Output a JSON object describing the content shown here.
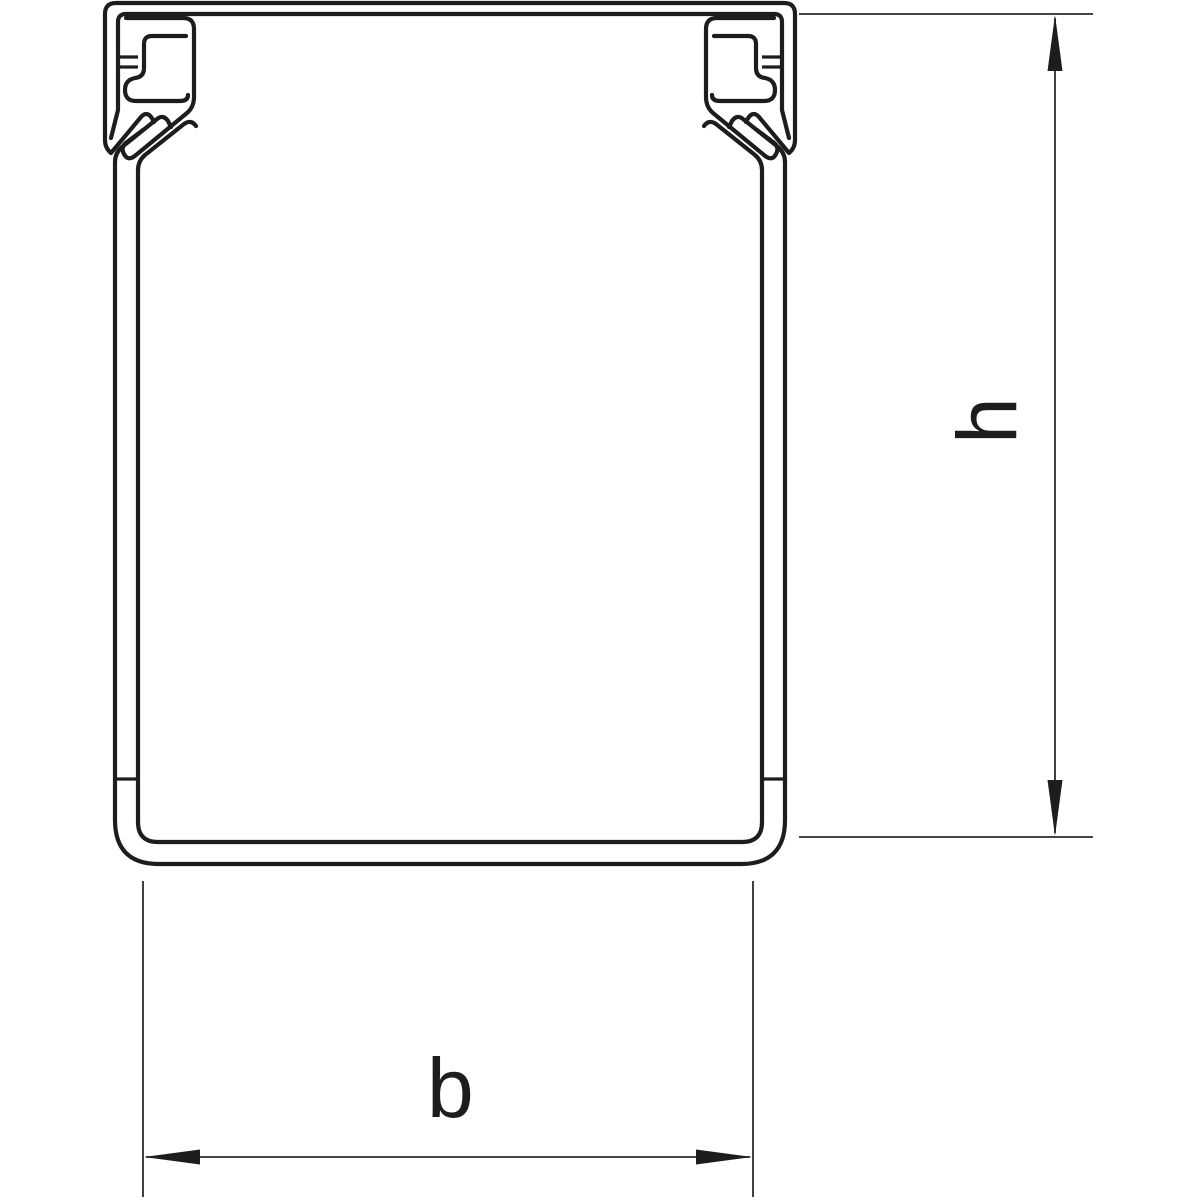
{
  "figure": {
    "kind": "technical-cross-section-drawing",
    "subject": "U-channel cable trunking profile with snap-on cover clips",
    "background_color": "#ffffff",
    "line_color": "#1d1d1b",
    "dimension_line_color": "#2b2b2b"
  },
  "labels": {
    "height": "h",
    "width": "b"
  }
}
